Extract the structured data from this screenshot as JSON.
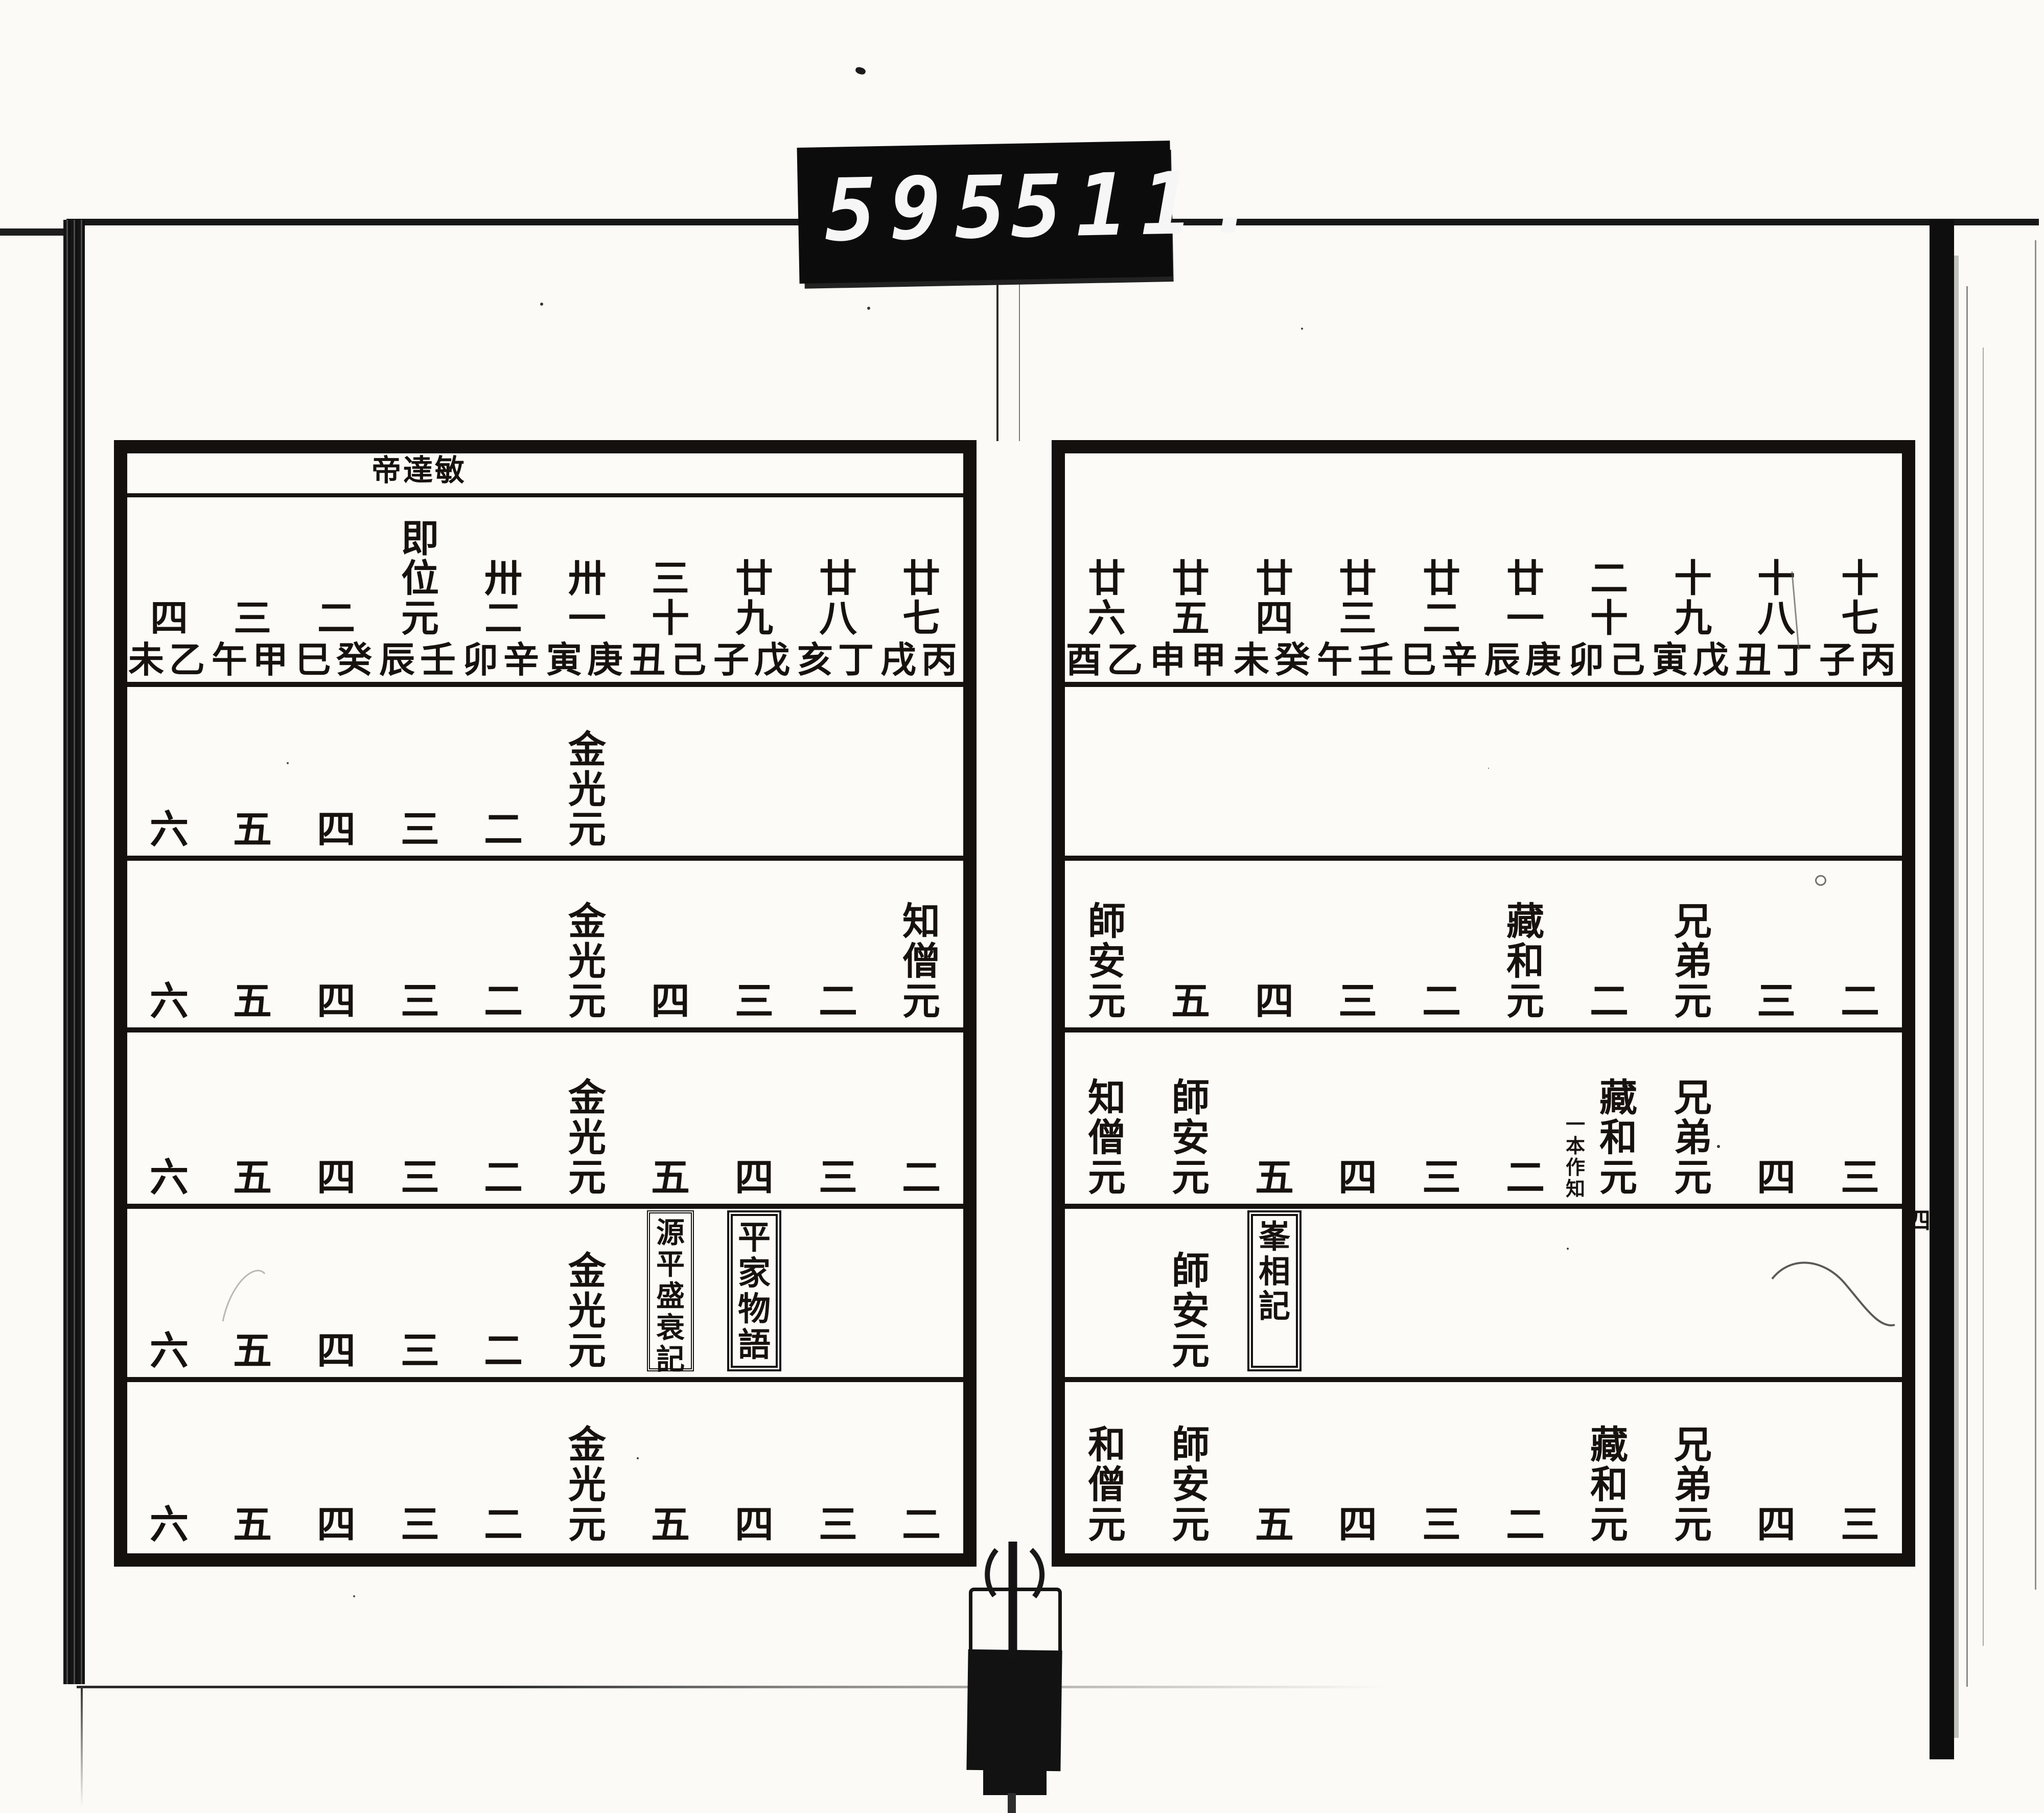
{
  "counter": {
    "left_digits": "595",
    "right_digits": "511."
  },
  "folio_marker": "四",
  "left_page": {
    "emperor_label": "帝達敏",
    "year_columns": [
      {
        "num": "四",
        "ganzhi": "未乙"
      },
      {
        "num": "三",
        "ganzhi": "午甲"
      },
      {
        "num": "二",
        "ganzhi": "巳癸"
      },
      {
        "num": "即位元",
        "ganzhi": "辰壬"
      },
      {
        "num": "卅二",
        "ganzhi": "卯辛"
      },
      {
        "num": "卅一",
        "ganzhi": "寅庚"
      },
      {
        "num": "三十",
        "ganzhi": "丑己"
      },
      {
        "num": "廿九",
        "ganzhi": "子戊"
      },
      {
        "num": "廿八",
        "ganzhi": "亥丁"
      },
      {
        "num": "廿七",
        "ganzhi": "戌丙"
      }
    ],
    "rows": [
      [
        {
          "i": 0,
          "t": "六",
          "k": "n"
        },
        {
          "i": 1,
          "t": "五",
          "k": "n"
        },
        {
          "i": 2,
          "t": "四",
          "k": "n"
        },
        {
          "i": 3,
          "t": "三",
          "k": "n"
        },
        {
          "i": 4,
          "t": "二",
          "k": "n"
        },
        {
          "i": 5,
          "t": "金光元",
          "k": "e"
        }
      ],
      [
        {
          "i": 0,
          "t": "六",
          "k": "n"
        },
        {
          "i": 1,
          "t": "五",
          "k": "n"
        },
        {
          "i": 2,
          "t": "四",
          "k": "n"
        },
        {
          "i": 3,
          "t": "三",
          "k": "n"
        },
        {
          "i": 4,
          "t": "二",
          "k": "n"
        },
        {
          "i": 5,
          "t": "金光元",
          "k": "e"
        },
        {
          "i": 6,
          "t": "四",
          "k": "n"
        },
        {
          "i": 7,
          "t": "三",
          "k": "n"
        },
        {
          "i": 8,
          "t": "二",
          "k": "n"
        },
        {
          "i": 9,
          "t": "知僧元",
          "k": "e"
        }
      ],
      [
        {
          "i": 0,
          "t": "六",
          "k": "n"
        },
        {
          "i": 1,
          "t": "五",
          "k": "n"
        },
        {
          "i": 2,
          "t": "四",
          "k": "n"
        },
        {
          "i": 3,
          "t": "三",
          "k": "n"
        },
        {
          "i": 4,
          "t": "二",
          "k": "n"
        },
        {
          "i": 5,
          "t": "金光元",
          "k": "e"
        },
        {
          "i": 6,
          "t": "五",
          "k": "n"
        },
        {
          "i": 7,
          "t": "四",
          "k": "n"
        },
        {
          "i": 8,
          "t": "三",
          "k": "n"
        },
        {
          "i": 9,
          "t": "二",
          "k": "n"
        }
      ],
      [
        {
          "i": 0,
          "t": "六",
          "k": "n"
        },
        {
          "i": 1,
          "t": "五",
          "k": "n"
        },
        {
          "i": 2,
          "t": "四",
          "k": "n"
        },
        {
          "i": 3,
          "t": "三",
          "k": "n"
        },
        {
          "i": 4,
          "t": "二",
          "k": "n"
        },
        {
          "i": 5,
          "t": "金光元",
          "k": "e"
        },
        {
          "i": 6,
          "t": "源平盛衰記",
          "k": "b"
        },
        {
          "i": 7,
          "t": "平家物語",
          "k": "bd"
        }
      ],
      [
        {
          "i": 0,
          "t": "六",
          "k": "n"
        },
        {
          "i": 1,
          "t": "五",
          "k": "n"
        },
        {
          "i": 2,
          "t": "四",
          "k": "n"
        },
        {
          "i": 3,
          "t": "三",
          "k": "n"
        },
        {
          "i": 4,
          "t": "二",
          "k": "n"
        },
        {
          "i": 5,
          "t": "金光元",
          "k": "e"
        },
        {
          "i": 6,
          "t": "五",
          "k": "n"
        },
        {
          "i": 7,
          "t": "四",
          "k": "n"
        },
        {
          "i": 8,
          "t": "三",
          "k": "n"
        },
        {
          "i": 9,
          "t": "二",
          "k": "n"
        }
      ]
    ]
  },
  "right_page": {
    "year_columns": [
      {
        "num": "廿六",
        "ganzhi": "酉乙"
      },
      {
        "num": "廿五",
        "ganzhi": "申甲"
      },
      {
        "num": "廿四",
        "ganzhi": "未癸"
      },
      {
        "num": "廿三",
        "ganzhi": "午壬"
      },
      {
        "num": "廿二",
        "ganzhi": "巳辛"
      },
      {
        "num": "廿一",
        "ganzhi": "辰庚"
      },
      {
        "num": "二十",
        "ganzhi": "卯己"
      },
      {
        "num": "十九",
        "ganzhi": "寅戊"
      },
      {
        "num": "十八",
        "ganzhi": "丑丁"
      },
      {
        "num": "十七",
        "ganzhi": "子丙"
      }
    ],
    "rows": [
      [],
      [
        {
          "i": 0,
          "t": "師安元",
          "k": "e"
        },
        {
          "i": 1,
          "t": "五",
          "k": "n"
        },
        {
          "i": 2,
          "t": "四",
          "k": "n"
        },
        {
          "i": 3,
          "t": "三",
          "k": "n"
        },
        {
          "i": 4,
          "t": "二",
          "k": "n"
        },
        {
          "i": 5,
          "t": "藏和元",
          "k": "e"
        },
        {
          "i": 6,
          "t": "二",
          "k": "n"
        },
        {
          "i": 7,
          "t": "兄弟元",
          "k": "e"
        },
        {
          "i": 8,
          "t": "三",
          "k": "n"
        },
        {
          "i": 9,
          "t": "二",
          "k": "n"
        }
      ],
      [
        {
          "i": 0,
          "t": "知僧元",
          "k": "e"
        },
        {
          "i": 1,
          "t": "師安元",
          "k": "e"
        },
        {
          "i": 2,
          "t": "五",
          "k": "n"
        },
        {
          "i": 3,
          "t": "四",
          "k": "n"
        },
        {
          "i": 4,
          "t": "三",
          "k": "n"
        },
        {
          "i": 5,
          "t": "二",
          "k": "n"
        },
        {
          "i": 6,
          "t": "藏和元",
          "k": "e",
          "n": "一本作知"
        },
        {
          "i": 7,
          "t": "兄弟元",
          "k": "e"
        },
        {
          "i": 8,
          "t": "四",
          "k": "n"
        },
        {
          "i": 9,
          "t": "三",
          "k": "n"
        }
      ],
      [
        {
          "i": 1,
          "t": "師安元",
          "k": "e"
        },
        {
          "i": 2,
          "t": "峯相記",
          "k": "bt"
        }
      ],
      [
        {
          "i": 0,
          "t": "和僧元",
          "k": "e"
        },
        {
          "i": 1,
          "t": "師安元",
          "k": "e"
        },
        {
          "i": 2,
          "t": "五",
          "k": "n"
        },
        {
          "i": 3,
          "t": "四",
          "k": "n"
        },
        {
          "i": 4,
          "t": "三",
          "k": "n"
        },
        {
          "i": 5,
          "t": "二",
          "k": "n"
        },
        {
          "i": 6,
          "t": "藏和元",
          "k": "e"
        },
        {
          "i": 7,
          "t": "兄弟元",
          "k": "e"
        },
        {
          "i": 8,
          "t": "四",
          "k": "n"
        },
        {
          "i": 9,
          "t": "三",
          "k": "n"
        }
      ]
    ]
  }
}
